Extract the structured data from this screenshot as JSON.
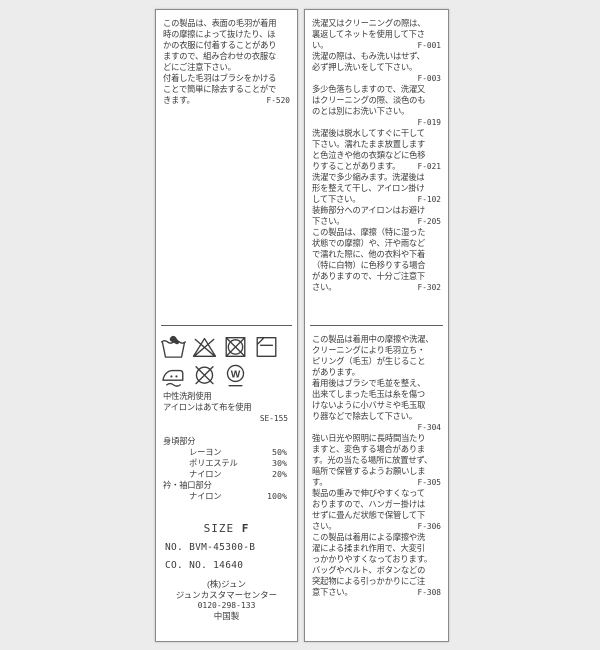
{
  "colors": {
    "background": "#ececec",
    "panel": "#ffffff",
    "panel_border": "#8a8a8a",
    "text": "#3a3a3a",
    "divider": "#5f5f5f"
  },
  "left_panel": {
    "top_lines": [
      {
        "t": "この製品は、表面の毛羽が着用"
      },
      {
        "t": "時の摩擦によって抜けたり、ほ"
      },
      {
        "t": "かの衣服に付着することがあり"
      },
      {
        "t": "ますので、組み合わせの衣服な"
      },
      {
        "t": "どにご注意下さい。"
      },
      {
        "t": "付着した毛羽はブラシをかける"
      },
      {
        "t": "ことで簡単に除去することがで"
      },
      {
        "t": "きます。",
        "c": "F-520"
      }
    ],
    "care_icons_row1": [
      "hand-wash-icon",
      "do-not-bleach-icon",
      "do-not-tumble-dry-icon",
      "dry-flat-in-shade-icon"
    ],
    "care_icons_row2": [
      "iron-with-pressing-cloth-icon",
      "do-not-dry-clean-icon",
      "professional-wet-clean-icon"
    ],
    "wet_clean_letter": "W",
    "notes_lines": [
      {
        "t": "中性洗剤使用"
      },
      {
        "t": "アイロンはあて布を使用"
      },
      {
        "t": "",
        "c": "SE-155"
      }
    ],
    "composition_lines": [
      {
        "t": "身頃部分"
      },
      {
        "t": "レーヨン",
        "c": "50%",
        "cls": "indent"
      },
      {
        "t": "ポリエステル",
        "c": "30%",
        "cls": "indent"
      },
      {
        "t": "ナイロン",
        "c": "20%",
        "cls": "indent"
      },
      {
        "t": "衿・袖口部分"
      },
      {
        "t": "ナイロン",
        "c": "100%",
        "cls": "indent"
      }
    ],
    "size_word": "SIZE",
    "size_value": "F",
    "product_no": "NO. BVM-45300-B",
    "co_no": "CO. NO. 14640",
    "company": "(株)ジュン",
    "customer_center": "ジュンカスタマーセンター",
    "phone": "0120-298-133",
    "origin": "中国製"
  },
  "right_panel": {
    "top_lines": [
      {
        "t": "洗濯又はクリーニングの際は、"
      },
      {
        "t": "裏返してネットを使用して下さ"
      },
      {
        "t": "い。",
        "c": "F-001"
      },
      {
        "t": "洗濯の際は、もみ洗いはせず、"
      },
      {
        "t": "必ず押し洗いをして下さい。"
      },
      {
        "t": "",
        "c": "F-003"
      },
      {
        "t": "多少色落ちしますので、洗濯又"
      },
      {
        "t": "はクリーニングの際、淡色のも"
      },
      {
        "t": "のとは別にお洗い下さい。"
      },
      {
        "t": "",
        "c": "F-019"
      },
      {
        "t": "洗濯後は脱水してすぐに干して"
      },
      {
        "t": "下さい。濡れたまま放置します"
      },
      {
        "t": "と色泣きや他の衣類などに色移"
      },
      {
        "t": "りすることがあります。",
        "c": "F-021"
      },
      {
        "t": "洗濯で多少縮みます。洗濯後は"
      },
      {
        "t": "形を整えて干し、アイロン掛け"
      },
      {
        "t": "して下さい。",
        "c": "F-102"
      },
      {
        "t": "装飾部分へのアイロンはお避け"
      },
      {
        "t": "下さい。",
        "c": "F-205"
      },
      {
        "t": "この製品は、摩擦（特に湿った"
      },
      {
        "t": "状態での摩擦）や、汗や雨など"
      },
      {
        "t": "で濡れた際に、他の衣料や下着"
      },
      {
        "t": "（特に白物）に色移りする場合"
      },
      {
        "t": "がありますので、十分ご注意下"
      },
      {
        "t": "さい。",
        "c": "F-302"
      }
    ],
    "bottom_lines": [
      {
        "t": "この製品は着用中の摩擦や洗濯、"
      },
      {
        "t": "クリーニングにより毛羽立ち・"
      },
      {
        "t": "ピリング（毛玉）が生じること"
      },
      {
        "t": "があります。"
      },
      {
        "t": "着用後はブラシで毛並を整え、"
      },
      {
        "t": "出来てしまった毛玉は糸を傷つ"
      },
      {
        "t": "けないように小バサミや毛玉取"
      },
      {
        "t": "り器などで除去して下さい。"
      },
      {
        "t": "",
        "c": "F-304"
      },
      {
        "t": "強い日光や照明に長時間当たり"
      },
      {
        "t": "ますと、変色する場合がありま"
      },
      {
        "t": "す。光の当たる場所に放置せず、"
      },
      {
        "t": "暗所で保管するようお願いしま"
      },
      {
        "t": "す。",
        "c": "F-305"
      },
      {
        "t": "製品の重みで伸びやすくなって"
      },
      {
        "t": "おりますので、ハンガー掛けは"
      },
      {
        "t": "せずに畳んだ状態で保管して下"
      },
      {
        "t": "さい。",
        "c": "F-306"
      },
      {
        "t": "この製品は着用による摩擦や洗"
      },
      {
        "t": "濯による揉まれ作用で、大変引"
      },
      {
        "t": "っかかりやすくなっております。"
      },
      {
        "t": "バッグやベルト、ボタンなどの"
      },
      {
        "t": "突起物による引っかかりにご注"
      },
      {
        "t": "意下さい。",
        "c": "F-308"
      }
    ]
  }
}
